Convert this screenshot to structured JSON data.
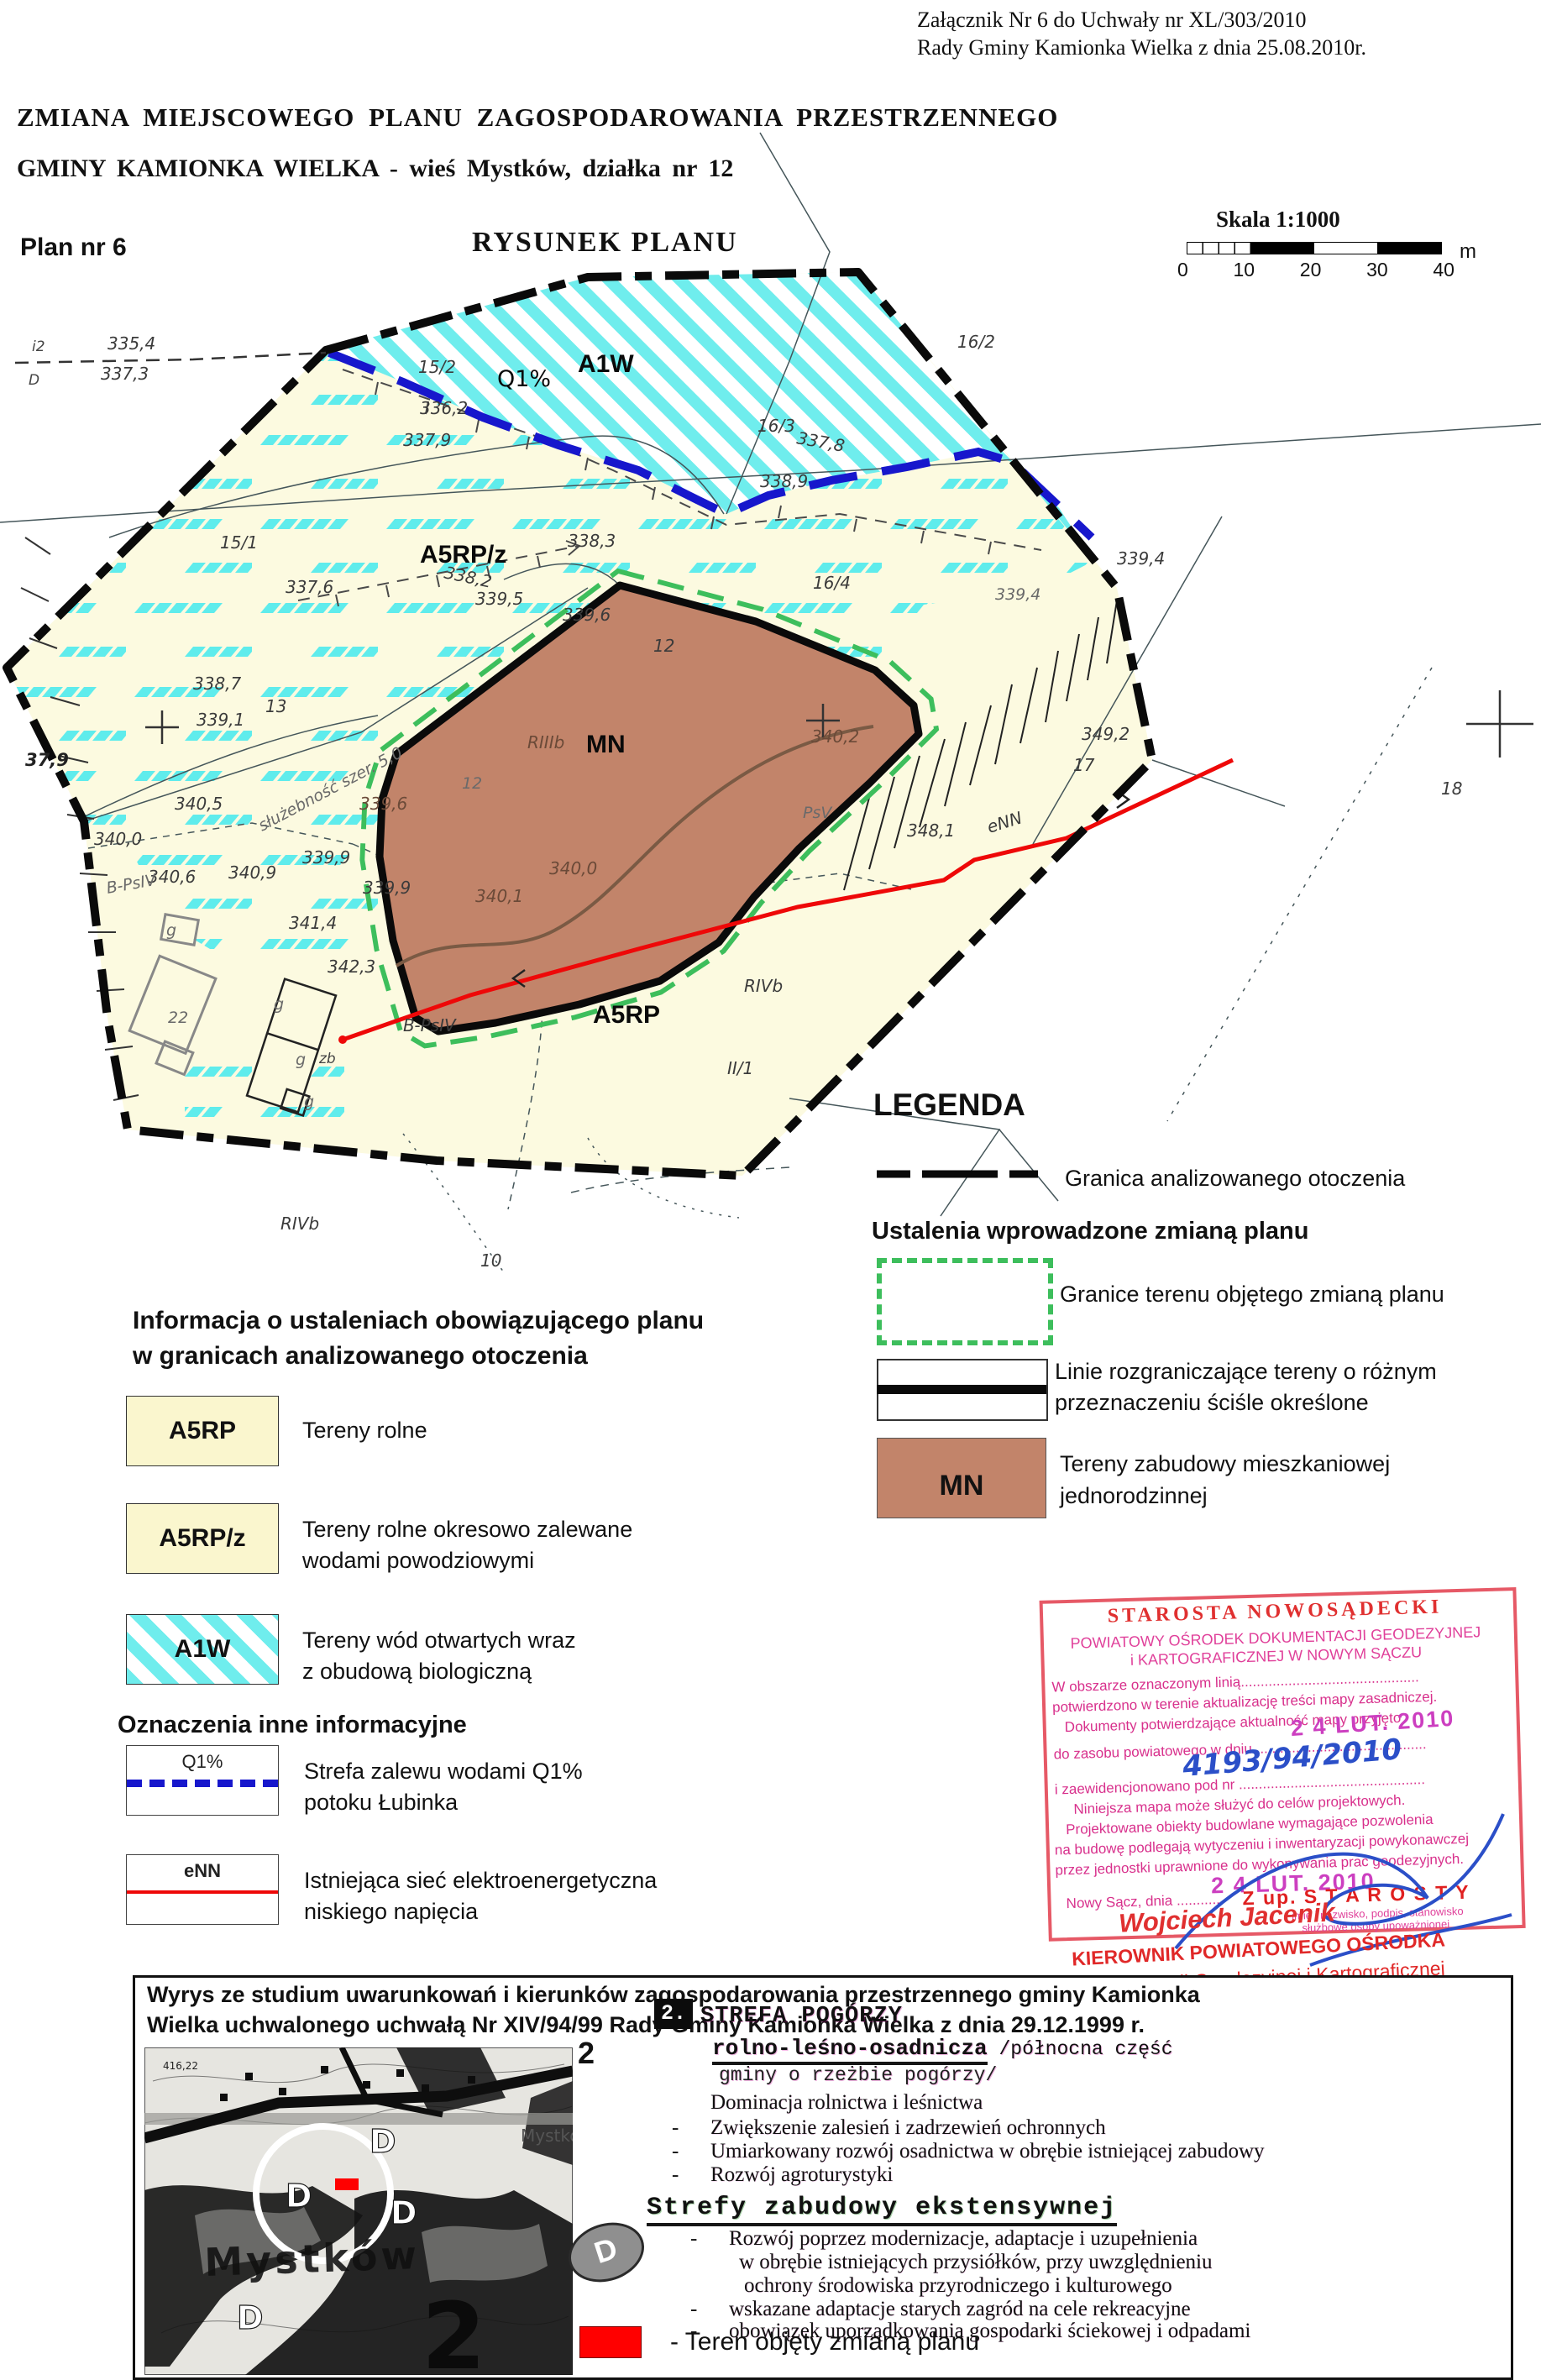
{
  "page": {
    "attachment_note1": "Załącznik Nr 6 do Uchwały nr XL/303/2010",
    "attachment_note2": "Rady Gminy Kamionka Wielka  z dnia 25.08.2010r.",
    "title_line1": "ZMIANA  MIEJSCOWEGO  PLANU  ZAGOSPODAROWANIA   PRZESTRZENNEGO",
    "title_line2": "GMINY KAMIONKA WIELKA   -  wieś Mystków,    działka nr 12",
    "plan_no": "Plan nr 6",
    "drawing_title": "RYSUNEK PLANU",
    "scale": {
      "label": "Skala 1:1000",
      "t0": "0",
      "t1": "10",
      "t2": "20",
      "t3": "30",
      "t4": "40",
      "unit": "m"
    }
  },
  "map": {
    "labels": {
      "z_a1w": "A1W",
      "z_a5rpz": "A5RP/z",
      "z_a5rp": "A5RP",
      "z_mn": "MN",
      "q1": "Q1%",
      "enn": "eNN",
      "i2": "i2",
      "d": "D",
      "e335_4": "335,4",
      "e337_3": "337,3",
      "p15_2": "15/2",
      "e336_2": "336,2",
      "e337_9": "337,9",
      "p16_2": "16/2",
      "p16_3": "16/3",
      "e337_8": "337,8",
      "e338_9": "338,9",
      "p16_4": "16/4",
      "e339_4a": "339,4",
      "e339_4b": "339,4",
      "p15_1": "15/1",
      "e338_3": "338,3",
      "e338_2": "338,2",
      "e337_6": "337,6",
      "e339_5": "339,5",
      "e339_6a": "339,6",
      "e339_6b": "339,6",
      "e338_7": "338,7",
      "p13": "13",
      "e339_1": "339,1",
      "e37_9": "37,9",
      "p12a": "12",
      "rIIIb": "RIIIb",
      "p12b": "12",
      "e340_2": "340,2",
      "psv": "PsV",
      "e348_1": "348,1",
      "e349_2": "349,2",
      "p17": "17",
      "p18": "18",
      "e339_9a": "339,9",
      "e339_9b": "339,9",
      "e341_4": "341,4",
      "e340_5": "340,5",
      "e340_0a": "340,0",
      "e340_6": "340,6",
      "e340_9": "340,9",
      "sluz": "służebność szer. 5,0",
      "bpsiv_a": "B-PsIV",
      "bpsiv_b": "B-PsIV",
      "e340_0b": "340,0",
      "e340_1": "340,1",
      "e342_3": "342,3",
      "rivb_a": "RIVb",
      "rivb_b": "RIVb",
      "p2_1": "II/1",
      "p10": "10",
      "g1": "g",
      "g2": "g",
      "g3": "g",
      "zb": "zb",
      "g4": "g",
      "p22": "22"
    }
  },
  "legend": {
    "title": "LEGENDA",
    "item1": "Granica analizowanego otoczenia",
    "section2": "Ustalenia wprowadzone zmianą planu",
    "item2": "Granice  terenu objętego zmianą planu",
    "item3a": "Linie rozgraniczające tereny o różnym",
    "item3b": "przeznaczeniu ściśle określone",
    "mn": "MN",
    "item4a": "Tereny zabudowy mieszkaniowej",
    "item4b": "jednorodzinnej"
  },
  "info": {
    "heading1a": "Informacja o ustaleniach obowiązującego planu",
    "heading1b": "w granicach analizowanego otoczenia",
    "a5rp": "A5RP",
    "a5rp_desc": "Tereny rolne",
    "a5rpz": "A5RP/z",
    "a5rpz_desc1": "Tereny rolne okresowo zalewane",
    "a5rpz_desc2": "wodami powodziowymi",
    "a1w": "A1W",
    "a1w_desc1": "Tereny wód otwartych wraz",
    "a1w_desc2": "z obudową biologiczną",
    "heading2": "Oznaczenia inne informacyjne",
    "q1": "Q1%",
    "q1_desc1": "Strefa zalewu wodami Q1%",
    "q1_desc2": "potoku Łubinka",
    "enn": "eNN",
    "enn_desc1": "Istniejąca sieć elektroenergetyczna",
    "enn_desc2": "niskiego napięcia"
  },
  "stamp": {
    "s1": "STAROSTA NOWOSĄDECKI",
    "s2": "POWIATOWY OŚRODEK DOKUMENTACJI GEODEZYJNEJ",
    "s3": "i KARTOGRAFICZNEJ W NOWYM SĄCZU",
    "s4": "W obszarze oznaczonym linią.............................................",
    "s5": "potwierdzono w terenie aktualizację treści mapy zasadniczej.",
    "s6": "Dokumenty potwierdzające aktualność mapy przyjęto",
    "s7": "do zasobu powiatowego w dniu ...........................................",
    "date": "2 4 LUT. 2010",
    "reg": "4193/94/2010",
    "s8": "i zaewidencjonowano pod nr ...............................................",
    "s9": "Niniejsza mapa może służyć do celów projektowych.",
    "s10": "Projektowane obiekty budowlane wymagające pozwolenia",
    "s11": "na budowę podlegają wytyczeniu i inwentaryzacji powykonawczej",
    "s12": "przez jednostki uprawnione do wykonywania prac geodezyjnych.",
    "s13": "Nowy Sącz, dnia ............",
    "s14": "Z up. S T A R O S T Y",
    "s15": "imię i nazwisko, podpis, stanowisko",
    "s16": "służbowe osoby upoważnionej",
    "sig_name": "Wojciech Jacenik",
    "sig_title1": "KIEROWNIK POWIATOWEGO OŚRODKA",
    "sig_title2": "Dokumentacji Geodezyjnej i Kartograficznej"
  },
  "study": {
    "header1": "Wyrys ze studium uwarunkowań i kierunków zagospodarowania przestrzennego gminy Kamionka",
    "header2": "Wielka  uchwalonego uchwałą Nr XIV/94/99 Rady Gminy Kamionka Wielka z dnia 29.12.1999 r.",
    "side2": "2",
    "num": "2.",
    "strefa": "STREFA POGÓRZY",
    "sub1": "rolno-leśno-osadnicza",
    "sub1b": " /północna część",
    "sub2": "gminy o rzeżbie pogórzy/",
    "b0": "Dominacja  rolnictwa i leśnictwa",
    "b1": "Zwiększenie zalesień i zadrzewień  ochronnych",
    "b2": "Umiarkowany rozwój osadnictwa  w obrębie istniejącej zabudowy",
    "b3": "Rozwój  agroturystyki",
    "strefy2": "Strefy  zabudowy ekstensywnej",
    "c1": "Rozwój poprzez modernizacje, adaptacje i uzupełnienia",
    "c2": "w obrębie istniejących przysiółków, przy uwzględnieniu",
    "c3": "ochrony środowiska przyrodniczego i kulturowego",
    "c4": "wskazane adaptacje starych zagród na cele rekreacyjne",
    "c5": "obowiązek uporządkowania gospodarki ściekowej i odpadami",
    "red_legend": "-  Teren objęty zmianą planu",
    "d_ellipse": "D",
    "map": {
      "mystkow_big": "Mystków",
      "mystkow_gray": "Mystków",
      "big2": "2",
      "d1": "D",
      "d2": "D",
      "d3": "D",
      "d4": "D",
      "e416": "416,22"
    }
  },
  "colors": {
    "beige": "#fcfae0",
    "cyan": "#6feded",
    "mn_brown": "#c2846a",
    "q1_blue": "#1717cc",
    "enn_red": "#ee0808",
    "green_dash": "#3dbe5c",
    "stamp_red": "#e03030",
    "stamp_magenta": "#d8308c",
    "hand_blue": "#2b4fc8"
  }
}
